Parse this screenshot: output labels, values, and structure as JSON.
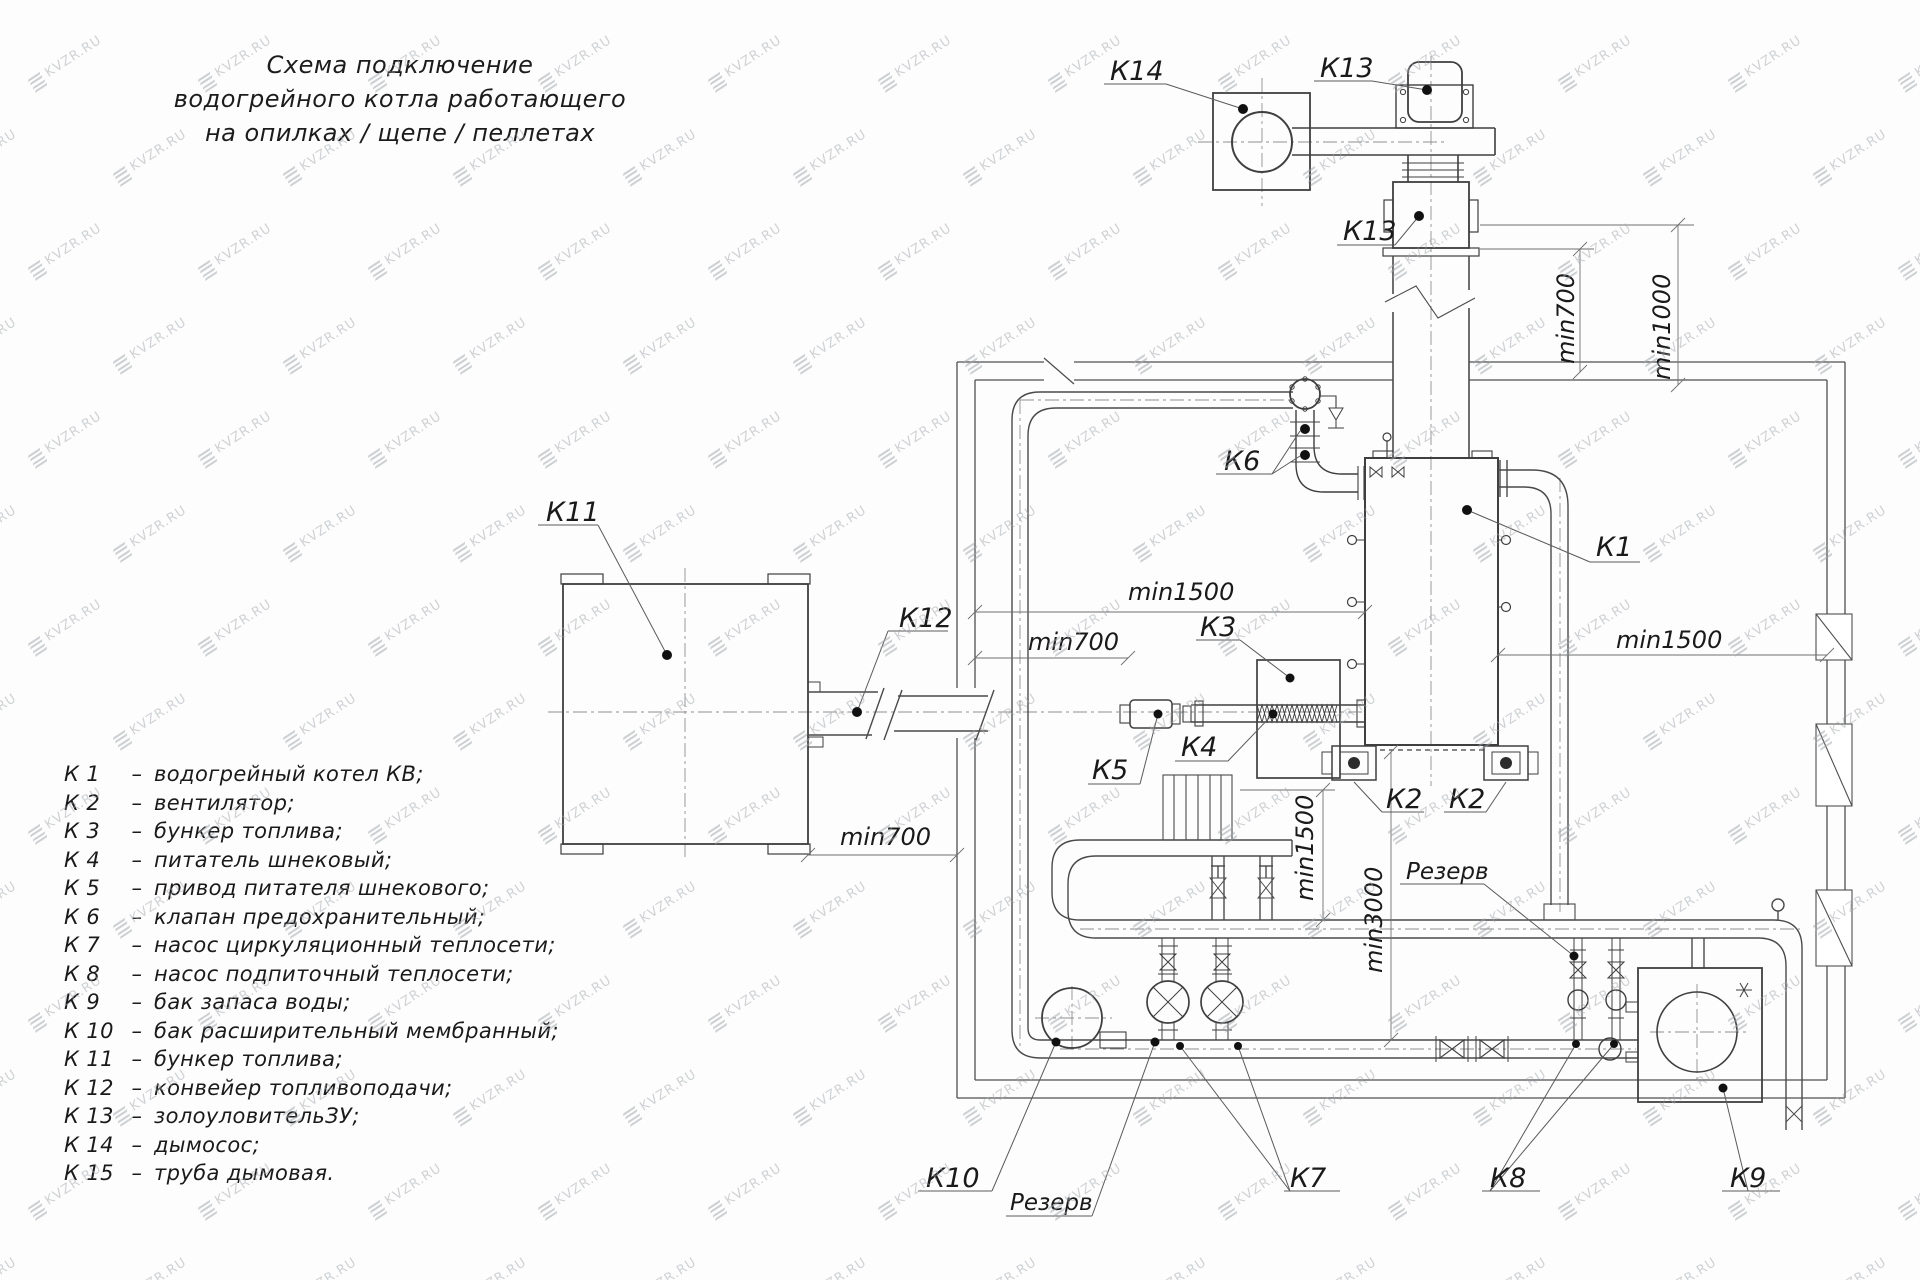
{
  "watermark": {
    "text": "KVZR.RU"
  },
  "title": {
    "line1": "Схема подключение",
    "line2": "водогрейного котла работающего",
    "line3": "на опилках / щепе / пеллетах"
  },
  "legend": {
    "separator": "–",
    "items": [
      {
        "key": "К 1",
        "desc": "водогрейный котел КВ;"
      },
      {
        "key": "К 2",
        "desc": "вентилятор;"
      },
      {
        "key": "К 3",
        "desc": "бункер топлива;"
      },
      {
        "key": "К 4",
        "desc": "питатель шнековый;"
      },
      {
        "key": "К 5",
        "desc": "привод питателя шнекового;"
      },
      {
        "key": "К 6",
        "desc": "клапан предохранительный;"
      },
      {
        "key": "К 7",
        "desc": "насос циркуляционный теплосети;"
      },
      {
        "key": "К 8",
        "desc": "насос подпиточный теплосети;"
      },
      {
        "key": "К 9",
        "desc": "бак запаса воды;"
      },
      {
        "key": "К 10",
        "desc": "бак расширительный мембранный;"
      },
      {
        "key": "К 11",
        "desc": "бункер топлива;"
      },
      {
        "key": "К 12",
        "desc": "конвейер топливоподачи;"
      },
      {
        "key": "К 13",
        "desc": "золоуловительЗУ;"
      },
      {
        "key": "К 14",
        "desc": "дымосос;"
      },
      {
        "key": "К 15",
        "desc": "труба дымовая."
      }
    ]
  },
  "labels": {
    "k1": "К1",
    "k2_left": "К2",
    "k2_right": "К2",
    "k3": "К3",
    "k4": "К4",
    "k5": "К5",
    "k6": "К6",
    "k7": "К7",
    "k8": "К8",
    "k9": "К9",
    "k10": "К10",
    "k11": "К11",
    "k12": "К12",
    "k13_top": "К13",
    "k13_mid": "К13",
    "k14": "К14",
    "rezerv_left": "Резерв",
    "rezerv_right": "Резерв"
  },
  "dimensions": {
    "left_min1500": "min1500",
    "left_min700": "min700",
    "bunker_min700": "min700",
    "right_min1500": "min1500",
    "mid_min1500": "min1500",
    "mid_min3000": "min3000",
    "roof_min700": "min700",
    "roof_min1000": "min1000"
  }
}
